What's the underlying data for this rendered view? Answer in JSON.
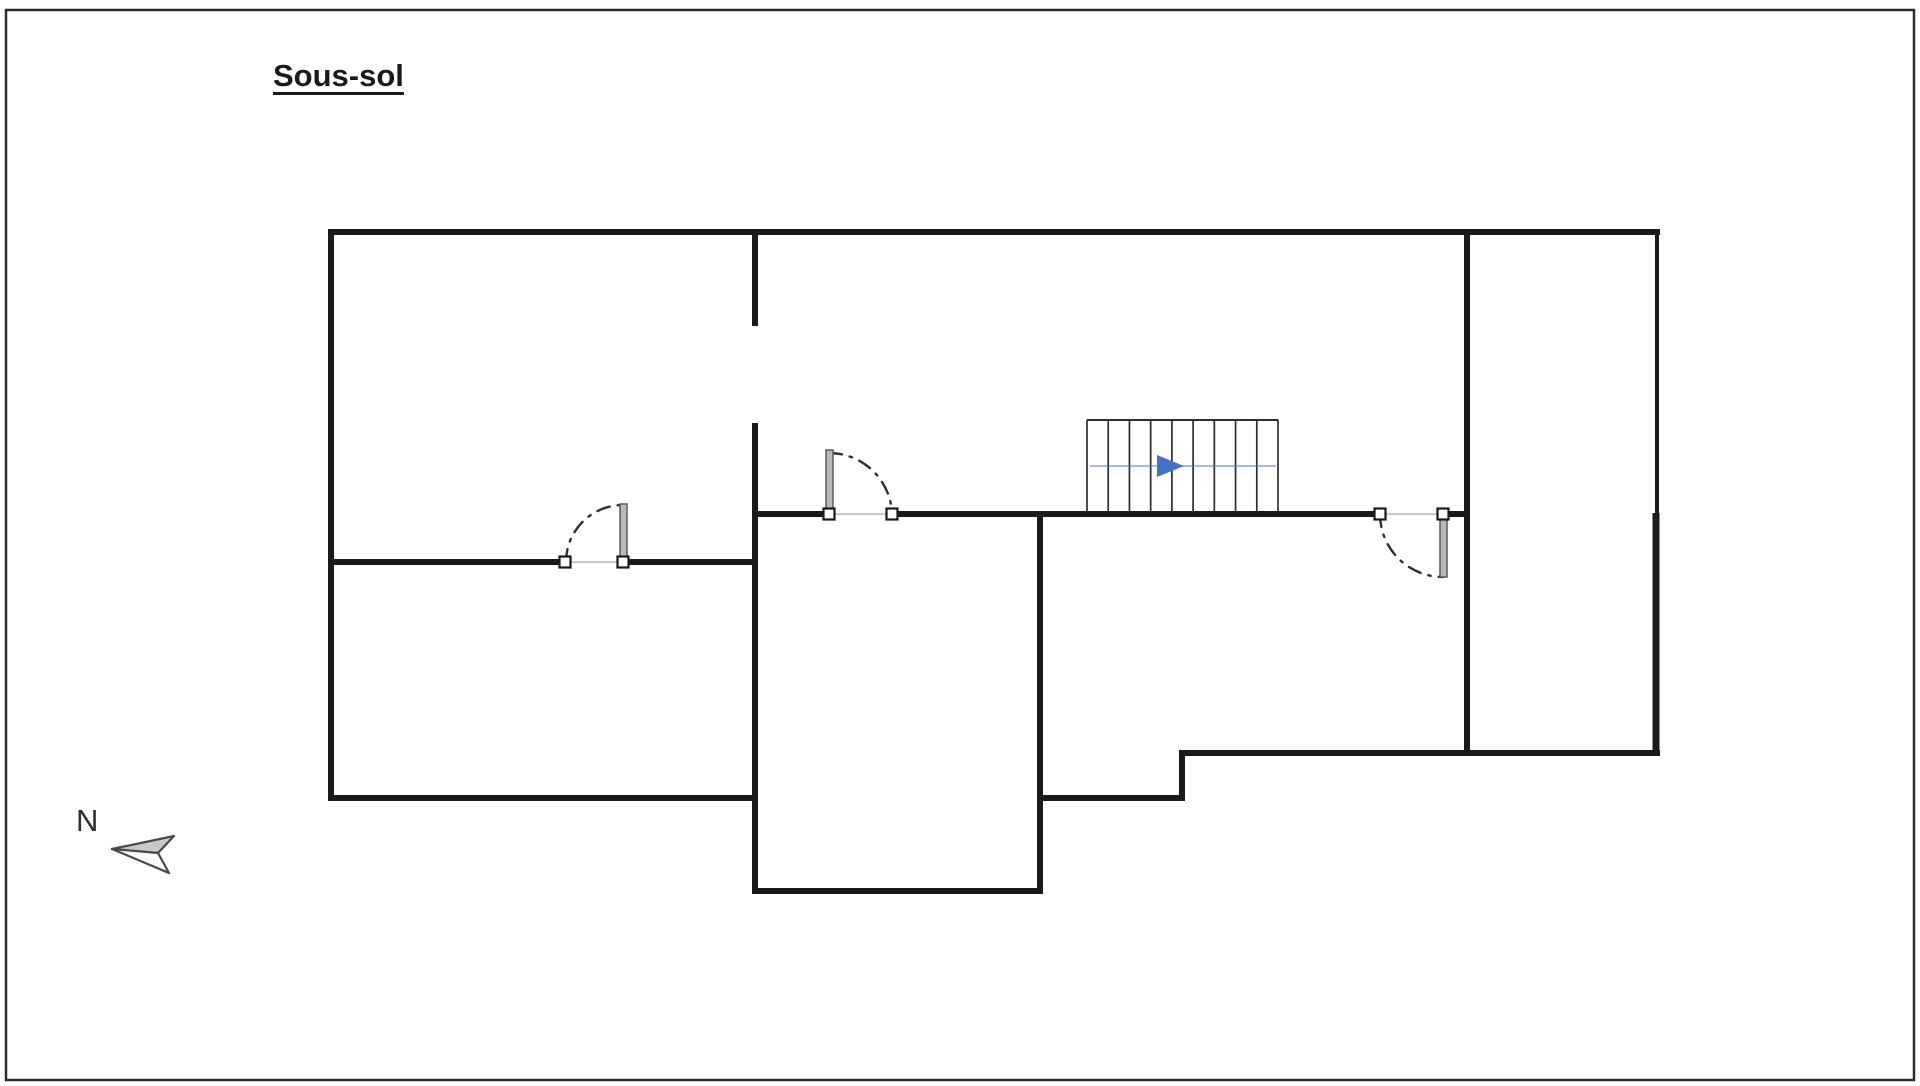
{
  "page": {
    "title": "Sous-sol",
    "background": "#ffffff",
    "frame": {
      "x": 6,
      "y": 10,
      "width": 1908,
      "height": 1070,
      "color": "#2b2b2b",
      "thickness": 2.5
    }
  },
  "canvas": {
    "width": 1920,
    "height": 1086
  },
  "colors": {
    "wall": "#1a1a1a",
    "opening_line": "#c9c9c9",
    "arc": "#2f2f2f",
    "door_leaf_fill": "#b9b9b9",
    "door_leaf_stroke": "#5a5a5a",
    "jamb_fill": "#ffffff",
    "jamb_stroke": "#1a1a1a",
    "stair_line": "#2e2e2e",
    "stair_arrow": "#4472C4",
    "compass_stroke": "#4a4a4a",
    "compass_fill_upper": "#c8c8c8",
    "compass_fill_lower": "#fdfdfd"
  },
  "plan": {
    "walls": [
      {
        "x1": 328,
        "y1": 232,
        "x2": 1660,
        "y2": 232,
        "w": 6
      },
      {
        "x1": 331,
        "y1": 229,
        "x2": 331,
        "y2": 801,
        "w": 6
      },
      {
        "x1": 328,
        "y1": 798,
        "x2": 758,
        "y2": 798,
        "w": 6
      },
      {
        "x1": 755,
        "y1": 229,
        "x2": 755,
        "y2": 326,
        "w": 6
      },
      {
        "x1": 755,
        "y1": 423,
        "x2": 755,
        "y2": 894,
        "w": 6
      },
      {
        "x1": 752,
        "y1": 891,
        "x2": 1043,
        "y2": 891,
        "w": 6
      },
      {
        "x1": 1040,
        "y1": 511,
        "x2": 1040,
        "y2": 894,
        "w": 6
      },
      {
        "x1": 1037,
        "y1": 798,
        "x2": 1185,
        "y2": 798,
        "w": 6
      },
      {
        "x1": 1182,
        "y1": 750,
        "x2": 1182,
        "y2": 801,
        "w": 6
      },
      {
        "x1": 1179,
        "y1": 753,
        "x2": 1660,
        "y2": 753,
        "w": 6
      },
      {
        "x1": 1657,
        "y1": 229,
        "x2": 1657,
        "y2": 513,
        "w": 4
      },
      {
        "x1": 1656,
        "y1": 513,
        "x2": 1656,
        "y2": 756,
        "w": 7
      },
      {
        "x1": 1467,
        "y1": 229,
        "x2": 1467,
        "y2": 756,
        "w": 6
      },
      {
        "x1": 752,
        "y1": 514,
        "x2": 830,
        "y2": 514,
        "w": 6
      },
      {
        "x1": 891,
        "y1": 514,
        "x2": 1381,
        "y2": 514,
        "w": 6
      },
      {
        "x1": 1442,
        "y1": 514,
        "x2": 1470,
        "y2": 514,
        "w": 6
      },
      {
        "x1": 328,
        "y1": 562,
        "x2": 566,
        "y2": 562,
        "w": 6
      },
      {
        "x1": 622,
        "y1": 562,
        "x2": 758,
        "y2": 562,
        "w": 6
      }
    ],
    "openings": [
      {
        "x1": 566,
        "y1": 562,
        "x2": 622,
        "y2": 562
      },
      {
        "x1": 830,
        "y1": 514,
        "x2": 891,
        "y2": 514
      },
      {
        "x1": 1381,
        "y1": 514,
        "x2": 1442,
        "y2": 514
      }
    ],
    "doors": [
      {
        "id": "door-left",
        "jambs": [
          [
            565,
            562
          ],
          [
            623,
            562
          ]
        ],
        "leaf": {
          "x": 620,
          "y": 504,
          "w": 7,
          "h": 53
        },
        "arc": {
          "from": [
            566,
            562
          ],
          "to": [
            623,
            505
          ],
          "r": 57,
          "sweep": 1
        }
      },
      {
        "id": "door-middle",
        "jambs": [
          [
            829,
            514
          ],
          [
            892,
            514
          ]
        ],
        "leaf": {
          "x": 826,
          "y": 450,
          "w": 7,
          "h": 59
        },
        "arc": {
          "from": [
            829,
            453
          ],
          "to": [
            892,
            514
          ],
          "r": 63,
          "sweep": 1
        }
      },
      {
        "id": "door-right",
        "jambs": [
          [
            1380,
            514
          ],
          [
            1443,
            514
          ]
        ],
        "leaf": {
          "x": 1440,
          "y": 519,
          "w": 7,
          "h": 58
        },
        "arc": {
          "from": [
            1380,
            514
          ],
          "to": [
            1443,
            577
          ],
          "r": 63,
          "sweep": 0
        }
      }
    ],
    "stairs": {
      "x": 1087,
      "y": 420,
      "width": 191,
      "height": 92,
      "tread_count": 9,
      "direction_line": {
        "y": 466,
        "x1": 1090,
        "x2": 1276
      },
      "arrow_head": {
        "points": [
          [
            1157,
            455
          ],
          [
            1184,
            466
          ],
          [
            1157,
            477
          ]
        ]
      }
    },
    "compass": {
      "label": "N",
      "upper": [
        [
          112,
          849
        ],
        [
          174,
          836
        ],
        [
          158,
          853
        ]
      ],
      "lower": [
        [
          112,
          849
        ],
        [
          158,
          853
        ],
        [
          169,
          873
        ]
      ]
    }
  }
}
